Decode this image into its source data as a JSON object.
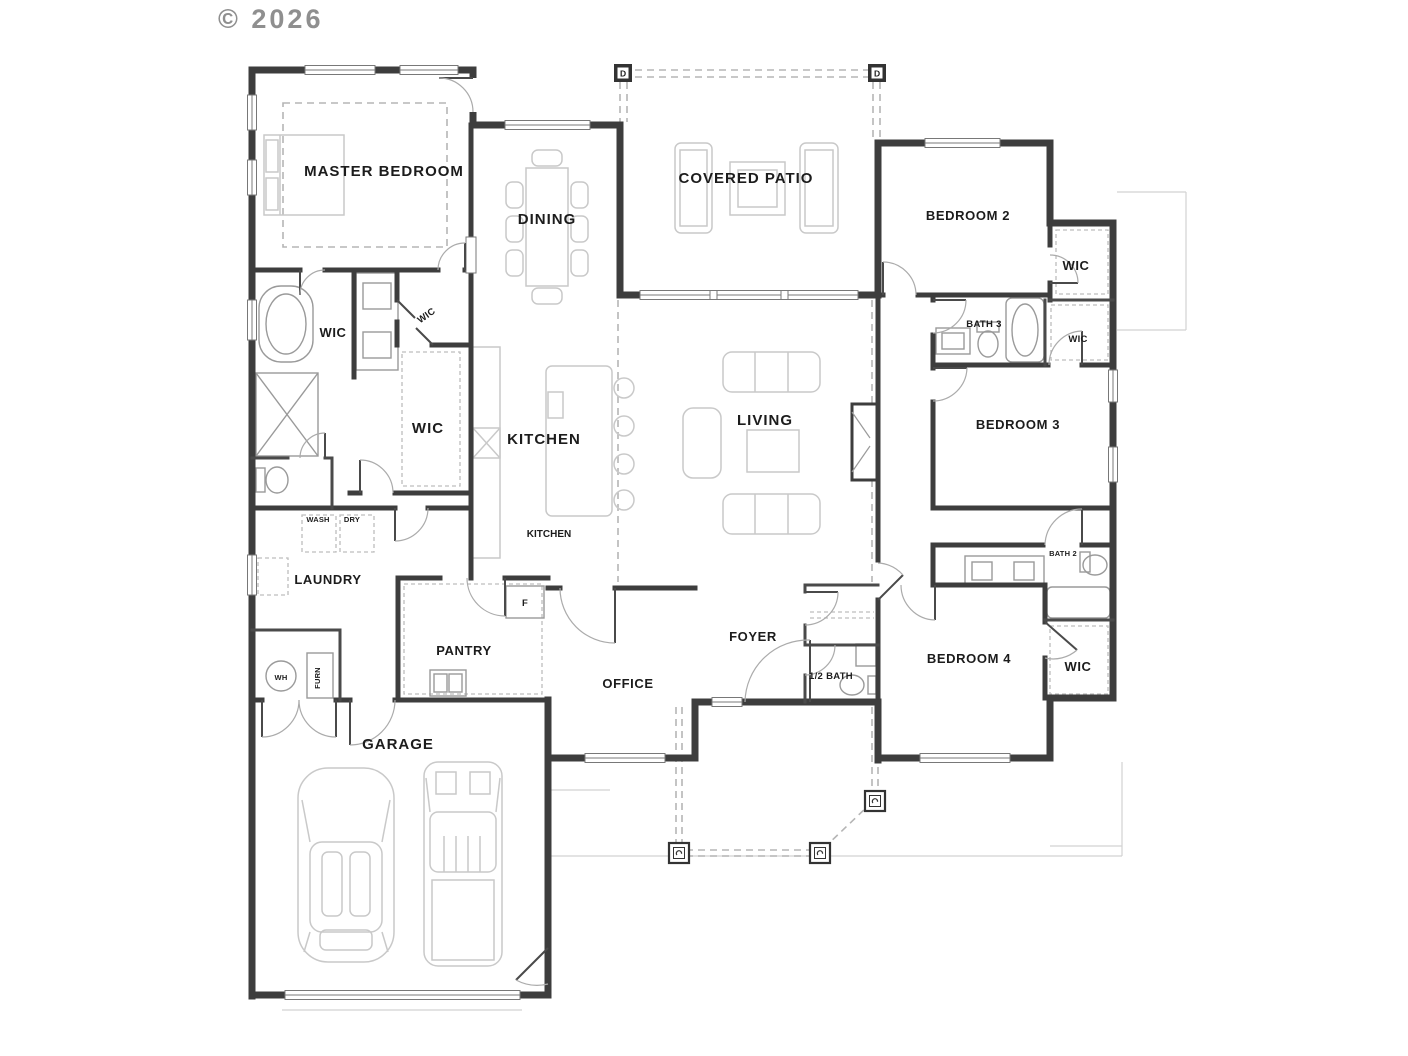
{
  "copyright": "© 2026",
  "labels": {
    "master_bedroom": "MASTER BEDROOM",
    "dining": "DINING",
    "covered_patio": "COVERED PATIO",
    "bedroom_2": "BEDROOM 2",
    "bedroom_3": "BEDROOM 3",
    "bedroom_4": "BEDROOM 4",
    "living": "LIVING",
    "kitchen": "KITCHEN",
    "wic": "WIC",
    "bath_3": "BATH 3",
    "bath_2": "BATH 2",
    "half_bath": "1/2 BATH",
    "laundry": "LAUNDRY",
    "wash": "WASH",
    "dry": "DRY",
    "pantry": "PANTRY",
    "office": "OFFICE",
    "foyer": "FOYER",
    "garage": "GARAGE",
    "water_heater": "WH",
    "furnace": "FURN",
    "fridge": "F",
    "post_d": "D"
  },
  "colors": {
    "wall": "#3d3d3d",
    "furniture": "#c9c9c9",
    "dashed_roof": "#b5b5b5",
    "text": "#1c1c1c",
    "copyright": "#8f8f8f",
    "background": "#ffffff"
  }
}
